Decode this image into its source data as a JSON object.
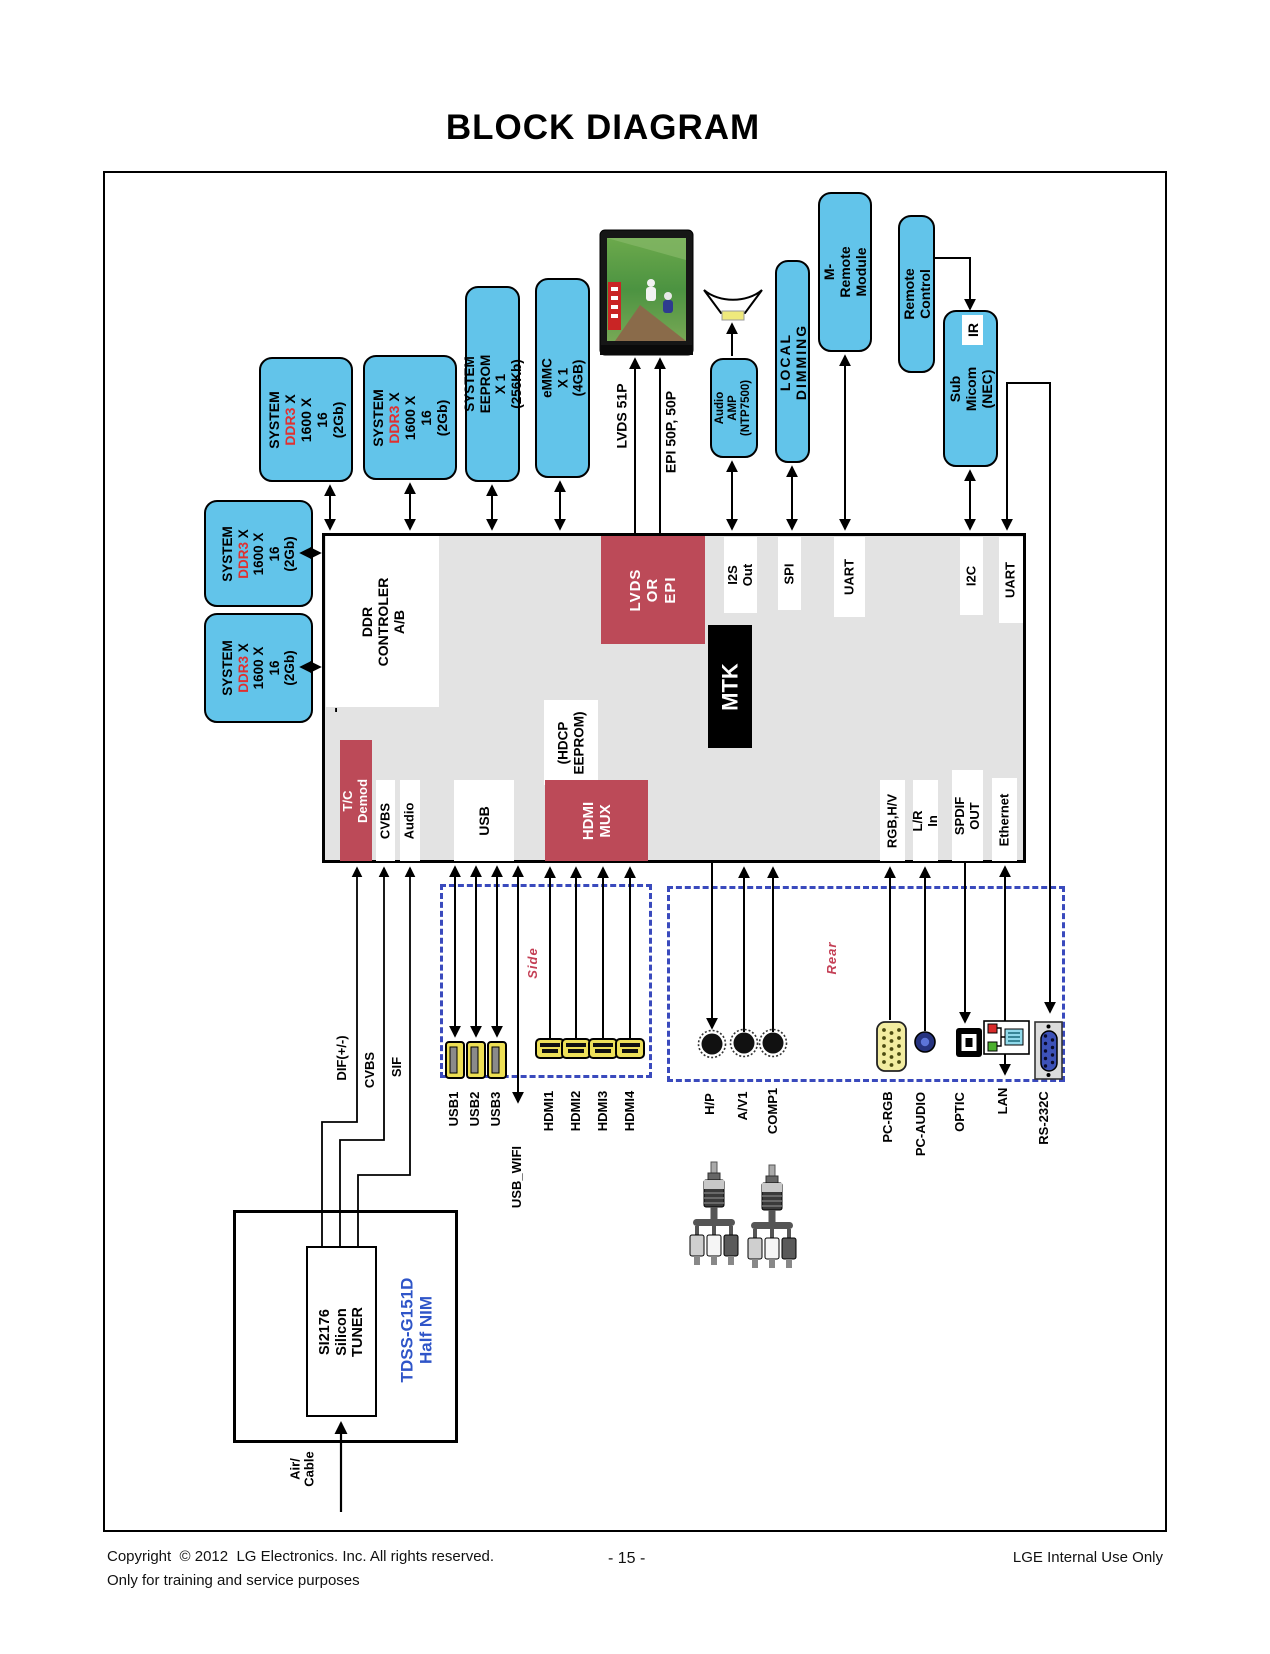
{
  "title": "BLOCK DIAGRAM",
  "blocks": {
    "ddr_top": {
      "l1": "SYSTEM",
      "red": "DDR3",
      "l2": " X",
      "l3": "1600 X 16",
      "l4": "(2Gb)"
    },
    "ddr_left": {
      "l1": "SYSTEM",
      "red": "DDR3",
      "l2": " X",
      "l3": "1600 X",
      "l4": "16",
      "l5": "(2Gb)"
    },
    "eeprom": "SYSTEM EEPROM X 1\n(256Kb)",
    "emmc": "eMMC X 1\n(4GB)",
    "audio_amp": "Audio\nAMP\n(NTP7500)",
    "local_dimming": "LOCAL DIMMING",
    "m_remote": "M-Remote\nModule",
    "remote_control": "Remote Control",
    "sub_micom": "Sub Micom\n(NEC)",
    "ir": "IR",
    "mtk": "MTK",
    "lvds_or_epi": "LVDS\nOR EPI",
    "ddr_controller": "DDR\nCONTROLER A/B",
    "dash": "-",
    "tc_demod": "T/C Demod",
    "hdmi_mux": "HDMI\nMUX",
    "hdcp_eeprom": "(HDCP\nEEPROM)"
  },
  "ports": {
    "i2s": "I2S Out",
    "spi": "SPI",
    "uart1": "UART",
    "i2c": "I2C",
    "uart2": "UART",
    "cvbs": "CVBS",
    "audio": "Audio",
    "usb": "USB",
    "rgbhv": "RGB,H/V",
    "lr_in": "L/R In",
    "spdif": "SPDIF OUT",
    "ethernet": "Ethernet"
  },
  "bus_labels": {
    "lvds": "LVDS 51P",
    "epi": "EPI 50P, 50P",
    "dif": "DIF(+/-)",
    "cvbs": "CVBS",
    "sif": "SIF"
  },
  "sections": {
    "side": "Side",
    "rear": "Rear"
  },
  "connectors": {
    "usb1": "USB1",
    "usb2": "USB2",
    "usb3": "USB3",
    "usb_wifi": "USB_WIFI",
    "hdmi1": "HDMI1",
    "hdmi2": "HDMI2",
    "hdmi3": "HDMI3",
    "hdmi4": "HDMI4",
    "hp": "H/P",
    "av1": "A/V1",
    "comp1": "COMP1",
    "pc_rgb": "PC-RGB",
    "pc_audio": "PC-AUDIO",
    "optic": "OPTIC",
    "lan": "LAN",
    "rs232c": "RS-232C"
  },
  "tuner": {
    "inner": "SI2176\nSilicon TUNER",
    "model": "TDSS-G151D\nHalf NIM",
    "input": "Air/\nCable"
  },
  "footer": {
    "copyright": "Copyright  © 2012  LG Electronics. Inc. All rights reserved.",
    "training": "Only for training and service purposes",
    "page_number": "- 15 -",
    "right": "LGE Internal Use Only"
  },
  "colors": {
    "box_blue": "#62C4EA",
    "accent_red": "#BC4A58",
    "label_red": "#C43F55",
    "dash_blue": "#3A4ABD",
    "ddr3_red": "#E03030",
    "tuner_text_blue": "#2F55C8"
  }
}
